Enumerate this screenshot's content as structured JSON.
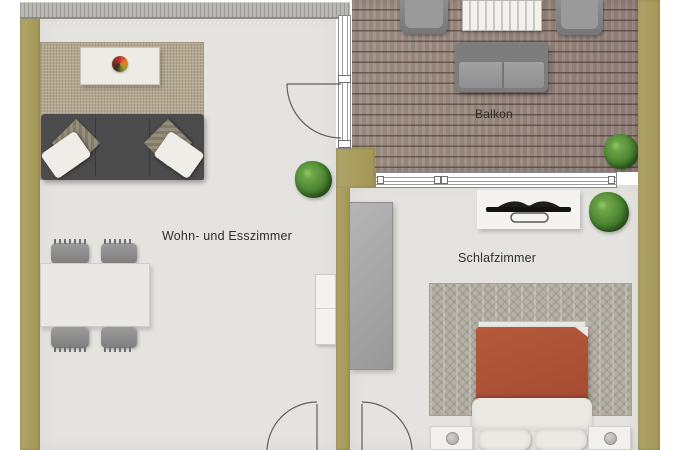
{
  "rooms": {
    "living": {
      "label": "Wohn- und Esszimmer"
    },
    "balcony": {
      "label": "Balkon"
    },
    "bedroom": {
      "label": "Schlafzimmer"
    }
  },
  "colors": {
    "wall": "#a89d60",
    "floor": "#e4e3e0",
    "balcony_deck": "#9a8b82",
    "living_rug": "#b2a68f",
    "bedroom_rug": "#b6b2a7",
    "sofa": "#4b4b4b",
    "gray_furniture": "#8f8f8f",
    "white_furniture": "#f3f2ef",
    "bed_duvet": "#ac5136",
    "plant": "#47822f",
    "label_text": "#2e2e2e"
  }
}
